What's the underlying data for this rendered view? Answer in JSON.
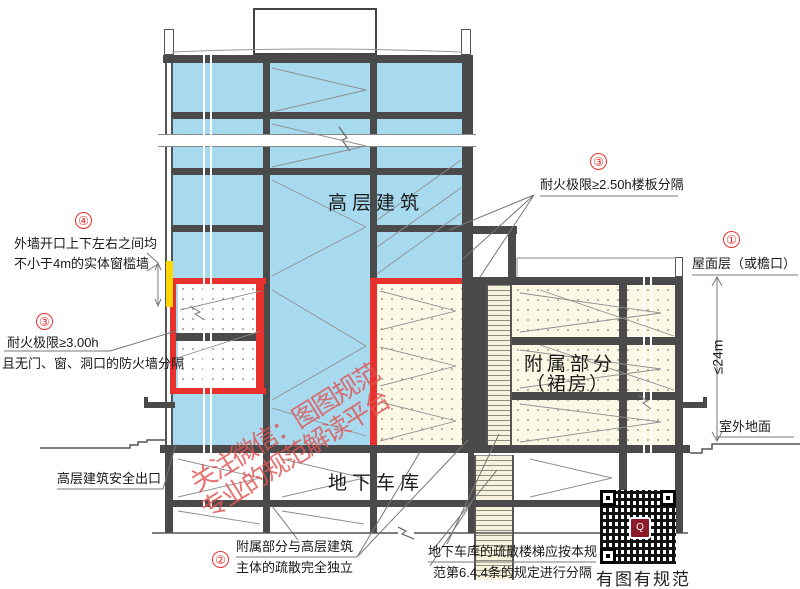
{
  "labels": {
    "tower": "高层建筑",
    "podium_line1": "附属部分",
    "podium_line2": "（裙房）",
    "garage": "地下车库"
  },
  "notes": {
    "n1": {
      "num": "①",
      "text": "屋面层（或檐口）"
    },
    "n2": {
      "num": "②",
      "line1": "附属部分与高层建筑",
      "line2": "主体的疏散完全独立"
    },
    "n3_top": {
      "num": "③",
      "text": "耐火极限≥2.50h楼板分隔"
    },
    "n3_left": {
      "num": "③",
      "line1": "耐火极限≥3.00h",
      "line2": "且无门、窗、洞口的防火墙分隔"
    },
    "n4": {
      "num": "④",
      "line1": "外墙开口上下左右之间均",
      "line2": "不小于4m的实体窗槛墙"
    },
    "exit": "高层建筑安全出口",
    "garage_stair_line1": "地下车库的疏散楼梯应按本规",
    "garage_stair_line2": "范第6.4.4条的规定进行分隔",
    "outdoor_ground": "室外地面",
    "height_dim": "≤24m"
  },
  "watermark": {
    "line1": "关注微信：图图规范",
    "line2": "专业的规范解读平台"
  },
  "qr": {
    "caption": "有图有规范",
    "logo": "Q"
  },
  "colors": {
    "tower_fill": "#a7daee",
    "podium_fill": "#fbf9e5",
    "fire_line": "#e8302c",
    "sill_wall_highlight": "#ffd503",
    "structure": "#4a4a4a",
    "watermark": "#e05454"
  }
}
